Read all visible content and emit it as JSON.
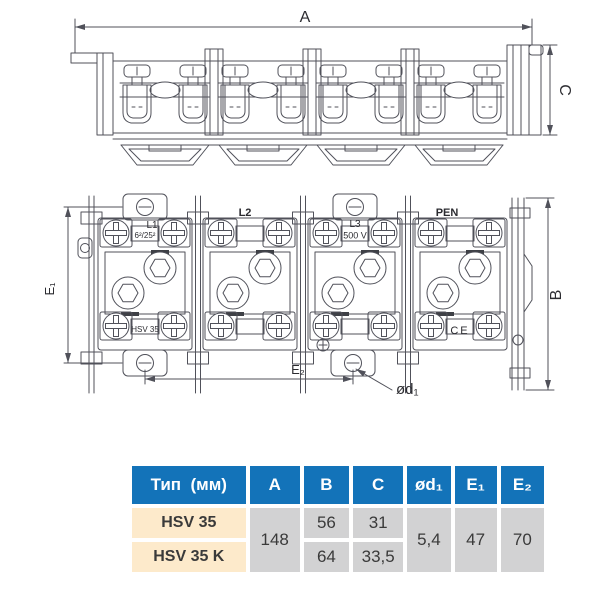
{
  "colors": {
    "line": "#50515a",
    "text": "#2b2b30",
    "header_bg": "#1373b9",
    "header_text": "#ffffff",
    "type_bg": "#fdeacb",
    "cell_bg": "#d2d2d3",
    "cell_text": "#3a3a3a"
  },
  "side_view": {
    "dim_a": "A",
    "dim_c": "C"
  },
  "front_view": {
    "dim_e1": "E₁",
    "dim_b": "B",
    "dim_e2": "E₂",
    "dim_d1": "ød₁",
    "label_l1": "L1",
    "label_l2": "L2",
    "label_l3": "L3",
    "label_pen": "PEN",
    "marking_range": "6²/25²",
    "marking_type": "HSV 35",
    "marking_voltage": "500 V",
    "marking_ce": "CE"
  },
  "table": {
    "col_type": "Тип  (мм)",
    "col_a": "A",
    "col_b": "B",
    "col_c": "C",
    "col_d1": "ød₁",
    "col_e1": "E₁",
    "col_e2": "E₂",
    "rows": [
      {
        "type": "HSV 35",
        "b": "56",
        "c": "31"
      },
      {
        "type": "HSV 35 K",
        "b": "64",
        "c": "33,5"
      }
    ],
    "shared": {
      "a": "148",
      "d1": "5,4",
      "e1": "47",
      "e2": "70"
    }
  }
}
